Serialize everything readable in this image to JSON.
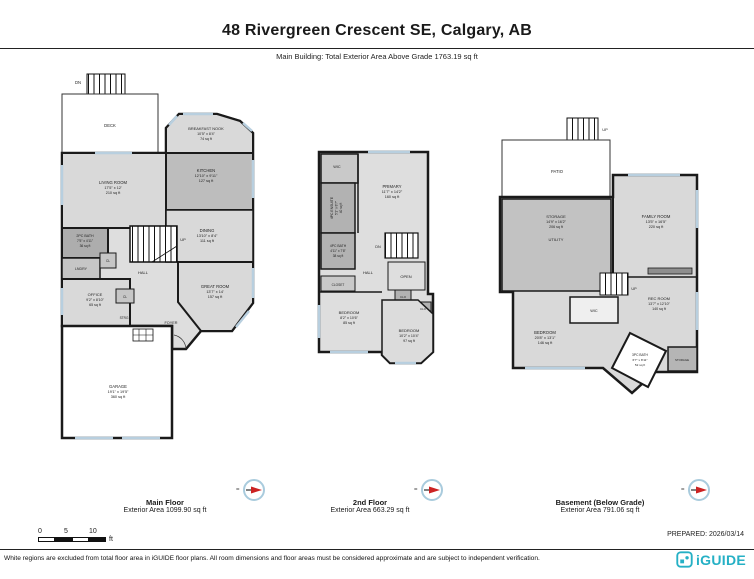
{
  "header": {
    "title": "48 Rivergreen Crescent SE, Calgary, AB",
    "subtitle": "Main Building: Total Exterior Area Above Grade 1763.19 sq ft"
  },
  "floors": {
    "main": {
      "title": "Main Floor",
      "area": "Exterior Area 1099.90 sq ft",
      "rooms": {
        "deck": {
          "label": "DECK"
        },
        "dn": "DN",
        "up": "UP",
        "breakfast": {
          "label": "BREAKFAST NOOK",
          "dims": "10'5\" x 8'4\"",
          "area": "74 sq ft"
        },
        "kitchen": {
          "label": "KITCHEN",
          "dims": "12'10\" x 9'11\"",
          "area": "127 sq ft"
        },
        "living": {
          "label": "LIVING ROOM",
          "dims": "17'5\" x 12'",
          "area": "210 sq ft"
        },
        "dining": {
          "label": "DINING",
          "dims": "13'10\" x 8'4\"",
          "area": "111 sq ft"
        },
        "bath2": {
          "label": "2PC BATH",
          "dims": "7'5\" x 4'11\"",
          "area": "36 sq ft"
        },
        "lndry": "LNDRY",
        "cl_a": "CL",
        "cl_b": "CL",
        "strg": "STRG",
        "hall": "HALL",
        "foyer": "FOYER",
        "office": {
          "label": "OFFICE",
          "dims": "9'2\" x 8'10\"",
          "area": "65 sq ft"
        },
        "great": {
          "label": "GREAT ROOM",
          "dims": "13'7\" x 14'",
          "area": "157 sq ft"
        },
        "garage": {
          "label": "GARAGE",
          "dims": "19'1\" x 19'5\"",
          "area": "360 sq ft"
        }
      }
    },
    "second": {
      "title": "2nd Floor",
      "area": "Exterior Area 663.29 sq ft",
      "rooms": {
        "wic": "WIC",
        "primary": {
          "label": "PRIMARY",
          "dims": "11'7\" x 14'2\"",
          "area": "160 sq ft"
        },
        "ensuite": {
          "label": "4PC ENSUITE",
          "dims": "5'1\" x 8'7\"",
          "area": "40 sq ft"
        },
        "bath4": {
          "label": "4PC BATH",
          "dims": "4'11\" x 7'8\"",
          "area": "38 sq ft"
        },
        "dn": "DN",
        "hall": "HALL",
        "open": "OPEN",
        "closet": "CLOSET",
        "clo_a": "CLO",
        "clo_b": "CLO",
        "bed_a": {
          "label": "BEDROOM",
          "dims": "8'2\" x 10'6\"",
          "area": "85 sq ft"
        },
        "bed_b": {
          "label": "BEDROOM",
          "dims": "10'2\" x 10'4\"",
          "area": "97 sq ft"
        }
      }
    },
    "basement": {
      "title": "Basement (Below Grade)",
      "area": "Exterior Area 791.06 sq ft",
      "rooms": {
        "up_top": "UP",
        "up_mid": "UP",
        "patio": "PATIO",
        "storage": {
          "label": "STORAGE",
          "dims": "14'9\" x 16'2\"",
          "area": "206 sq ft"
        },
        "utility": "UTILITY",
        "family": {
          "label": "FAMILY ROOM",
          "dims": "13'5\" x 16'5\"",
          "area": "220 sq ft"
        },
        "wic": "WIC",
        "rec": {
          "label": "REC ROOM",
          "dims": "13'7\" x 12'10\"",
          "area": "140 sq ft"
        },
        "bedroom": {
          "label": "BEDROOM",
          "dims": "20'8\" x 13'1\"",
          "area": "146 sq ft"
        },
        "bath3": {
          "label": "3PC BATH",
          "dims": "6'7\" x 8'11\"",
          "area": "52 sq ft"
        },
        "storage_small": "STORAGE"
      }
    }
  },
  "footer": {
    "compass_eq": "=",
    "scale": {
      "t0": "0",
      "t5": "5",
      "t10": "10",
      "unit": "ft"
    },
    "prepared": "PREPARED: 2026/03/14",
    "disclaimer": "White regions are excluded from total floor area in iGUIDE floor plans. All room dimensions and floor areas must be considered approximate and are subject to independent verification.",
    "logo_text": "iGUIDE"
  }
}
